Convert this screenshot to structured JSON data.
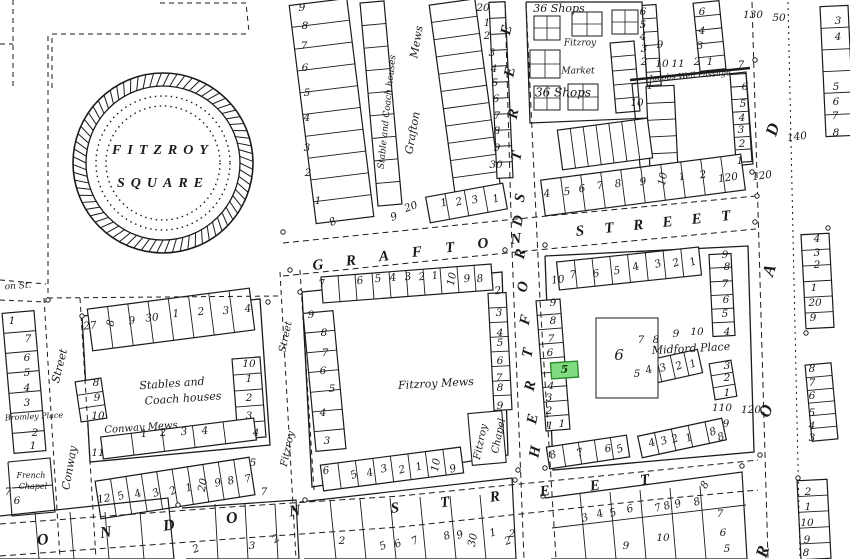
{
  "map": {
    "background": "#ffffff",
    "ink": "#1b1b1b",
    "square": {
      "name_line1": "FITZROY",
      "name_line2": "SQUARE",
      "cx": 163,
      "cy": 163,
      "r_outer": 90,
      "r_inner": 77,
      "r_dot1": 67,
      "r_dot2": 57
    },
    "highlight": {
      "number": "5",
      "x": 551,
      "y": 362,
      "w": 27,
      "h": 16,
      "rot": -4,
      "fill": "#80DC80",
      "stroke": "#2E8B2E",
      "text_color": "#14430F"
    },
    "street_names": [
      {
        "t": "GRAFTON",
        "x1": 318,
        "y1": 266,
        "x2": 516,
        "y2": 240,
        "s": 15,
        "lr": -6
      },
      {
        "t": "STREET",
        "x1": 580,
        "y1": 232,
        "x2": 726,
        "y2": 217,
        "s": 15,
        "lr": -6
      },
      {
        "t": "HERTFORD",
        "x1": 536,
        "y1": 452,
        "x2": 519,
        "y2": 221,
        "s": 15,
        "lr": -78
      },
      {
        "t": "STREET",
        "x1": 521,
        "y1": 198,
        "x2": 504,
        "y2": -12,
        "s": 15,
        "lr": -78
      },
      {
        "t": "LONDON",
        "x1": -20,
        "y1": 548,
        "x2": 295,
        "y2": 512,
        "s": 16,
        "lr": -8
      },
      {
        "t": "STREET",
        "x1": 395,
        "y1": 509,
        "x2": 645,
        "y2": 481,
        "s": 15,
        "lr": -8
      },
      {
        "t": "ROAD",
        "x1": 764,
        "y1": 552,
        "x2": 774,
        "y2": 130,
        "s": 17,
        "lr": -72
      }
    ],
    "labels": [
      {
        "t": "36 Shops",
        "x": 559,
        "y": 9,
        "s": 11
      },
      {
        "t": "Fitzroy",
        "x": 580,
        "y": 43,
        "s": 9
      },
      {
        "t": "Market",
        "x": 578,
        "y": 71,
        "s": 9
      },
      {
        "t": "36 Shops",
        "x": 563,
        "y": 93,
        "s": 12
      },
      {
        "t": "Jacobs Well Passage",
        "x": 690,
        "y": 76,
        "s": 8,
        "r": -4
      },
      {
        "t": "Mews",
        "x": 417,
        "y": 42,
        "s": 11,
        "r": -80
      },
      {
        "t": "Grafton",
        "x": 413,
        "y": 133,
        "s": 11,
        "r": -80
      },
      {
        "t": "Stable and Coach houses",
        "x": 387,
        "y": 112,
        "s": 9,
        "r": -84
      },
      {
        "t": "on St.",
        "x": 18,
        "y": 286,
        "s": 9,
        "r": -4
      },
      {
        "t": "Street",
        "x": 60,
        "y": 366,
        "s": 11,
        "r": -76
      },
      {
        "t": "Conway",
        "x": 70,
        "y": 468,
        "s": 11,
        "r": -80
      },
      {
        "t": "Bromley Place",
        "x": 34,
        "y": 417,
        "s": 8,
        "r": -3
      },
      {
        "t": "French",
        "x": 31,
        "y": 476,
        "s": 8
      },
      {
        "t": "Chapel",
        "x": 33,
        "y": 487,
        "s": 8
      },
      {
        "t": "Stables and",
        "x": 172,
        "y": 384,
        "s": 11,
        "r": -4
      },
      {
        "t": "Coach houses",
        "x": 183,
        "y": 399,
        "s": 11,
        "r": -4
      },
      {
        "t": "Conway Mews",
        "x": 141,
        "y": 428,
        "s": 10,
        "r": -4
      },
      {
        "t": "Street",
        "x": 286,
        "y": 337,
        "s": 10,
        "r": -78
      },
      {
        "t": "Fitzroy",
        "x": 288,
        "y": 449,
        "s": 10,
        "r": -78
      },
      {
        "t": "Fitzroy Mews",
        "x": 436,
        "y": 384,
        "s": 11,
        "r": -3
      },
      {
        "t": "Fitzroy",
        "x": 481,
        "y": 442,
        "s": 10,
        "r": -78
      },
      {
        "t": "Chapel",
        "x": 499,
        "y": 436,
        "s": 10,
        "r": -78
      },
      {
        "t": "Midford Place",
        "x": 691,
        "y": 349,
        "s": 11,
        "r": -3
      }
    ],
    "numbers": [
      [
        "9",
        302,
        8
      ],
      [
        "8",
        305,
        26
      ],
      [
        "7",
        304,
        46
      ],
      [
        "6",
        305,
        68
      ],
      [
        "5",
        307,
        93
      ],
      [
        "4",
        307,
        118
      ],
      [
        "3",
        307,
        148
      ],
      [
        "2",
        308,
        173
      ],
      [
        "1",
        318,
        201
      ],
      [
        "8",
        333,
        222,
        -30
      ],
      [
        "9",
        394,
        217,
        -20
      ],
      [
        "20",
        411,
        207,
        -20
      ],
      [
        "20",
        483,
        8
      ],
      [
        "1",
        487,
        23
      ],
      [
        "2",
        487,
        36
      ],
      [
        "3",
        492,
        53
      ],
      [
        "4",
        494,
        69
      ],
      [
        "5",
        495,
        83
      ],
      [
        "6",
        496,
        99
      ],
      [
        "7",
        497,
        116
      ],
      [
        "8",
        497,
        131
      ],
      [
        "9",
        497,
        148
      ],
      [
        "30",
        496,
        165
      ],
      [
        "1",
        444,
        203,
        -15
      ],
      [
        "2",
        459,
        202,
        -15
      ],
      [
        "3",
        475,
        200,
        -15
      ],
      [
        "1",
        496,
        199,
        -15
      ],
      [
        "6",
        643,
        12
      ],
      [
        "5",
        643,
        25
      ],
      [
        "4",
        643,
        37
      ],
      [
        "3",
        644,
        49
      ],
      [
        "2",
        644,
        62
      ],
      [
        "9",
        660,
        45
      ],
      [
        "10",
        662,
        64
      ],
      [
        "11",
        678,
        64
      ],
      [
        "6",
        702,
        12
      ],
      [
        "4",
        702,
        31
      ],
      [
        "3",
        700,
        46
      ],
      [
        "2",
        697,
        62
      ],
      [
        "1",
        710,
        62
      ],
      [
        "1",
        650,
        86
      ],
      [
        "10",
        637,
        103
      ],
      [
        "7",
        741,
        65
      ],
      [
        "6",
        745,
        87
      ],
      [
        "5",
        743,
        104
      ],
      [
        "4",
        742,
        118
      ],
      [
        "3",
        741,
        130
      ],
      [
        "2",
        742,
        144
      ],
      [
        "1",
        740,
        161
      ],
      [
        "4",
        547,
        194,
        -8
      ],
      [
        "5",
        567,
        192,
        -8
      ],
      [
        "6",
        582,
        189,
        -8
      ],
      [
        "7",
        600,
        186,
        -8
      ],
      [
        "8",
        618,
        184,
        -8
      ],
      [
        "9",
        643,
        182,
        -8
      ],
      [
        "10",
        663,
        179,
        -80
      ],
      [
        "1",
        682,
        177,
        -8
      ],
      [
        "2",
        703,
        175,
        -8
      ],
      [
        "120",
        728,
        178,
        -8
      ],
      [
        "120",
        762,
        176,
        -8
      ],
      [
        "140",
        797,
        137,
        -8
      ],
      [
        "130",
        753,
        15
      ],
      [
        "50",
        779,
        18
      ],
      [
        "7",
        322,
        284,
        -8
      ],
      [
        "6",
        360,
        281,
        -8
      ],
      [
        "5",
        378,
        279,
        -8
      ],
      [
        "4",
        393,
        278,
        -8
      ],
      [
        "3",
        408,
        277,
        -8
      ],
      [
        "2",
        422,
        277,
        -8
      ],
      [
        "1",
        435,
        276,
        -8
      ],
      [
        "10",
        452,
        279,
        -80
      ],
      [
        "9",
        467,
        279,
        -8
      ],
      [
        "8",
        480,
        279,
        -8
      ],
      [
        "2",
        498,
        291,
        -8
      ],
      [
        "9",
        311,
        315
      ],
      [
        "8",
        324,
        333
      ],
      [
        "7",
        325,
        353
      ],
      [
        "6",
        323,
        371
      ],
      [
        "5",
        332,
        389
      ],
      [
        "4",
        323,
        413
      ],
      [
        "3",
        327,
        441
      ],
      [
        "3",
        499,
        313
      ],
      [
        "4",
        500,
        333
      ],
      [
        "5",
        500,
        343
      ],
      [
        "6",
        500,
        361
      ],
      [
        "7",
        499,
        378
      ],
      [
        "8",
        500,
        388
      ],
      [
        "9",
        500,
        406
      ],
      [
        "6",
        326,
        471,
        -8
      ],
      [
        "5",
        354,
        475,
        -25
      ],
      [
        "4",
        370,
        473,
        -15
      ],
      [
        "3",
        384,
        469,
        -15
      ],
      [
        "2",
        402,
        470,
        -15
      ],
      [
        "1",
        419,
        467,
        -15
      ],
      [
        "10",
        436,
        465,
        -80
      ],
      [
        "9",
        453,
        469,
        -15
      ],
      [
        "27",
        90,
        326,
        -5
      ],
      [
        "8",
        111,
        323,
        -80
      ],
      [
        "9",
        132,
        321,
        -5
      ],
      [
        "30",
        152,
        318,
        -5
      ],
      [
        "1",
        176,
        314,
        -5
      ],
      [
        "2",
        201,
        312,
        -5
      ],
      [
        "3",
        226,
        311,
        -5
      ],
      [
        "4",
        248,
        309,
        -5
      ],
      [
        "8",
        96,
        383
      ],
      [
        "9",
        97,
        398
      ],
      [
        "10",
        98,
        416
      ],
      [
        "10",
        249,
        364
      ],
      [
        "1",
        249,
        379
      ],
      [
        "2",
        249,
        398
      ],
      [
        "3",
        249,
        416
      ],
      [
        "1",
        144,
        434,
        -5
      ],
      [
        "2",
        163,
        433,
        -5
      ],
      [
        "3",
        184,
        432,
        -5
      ],
      [
        "4",
        205,
        431,
        -5
      ],
      [
        "11",
        98,
        453
      ],
      [
        "12",
        104,
        499,
        -10
      ],
      [
        "5",
        121,
        496,
        -25
      ],
      [
        "4",
        138,
        494,
        -25
      ],
      [
        "3",
        156,
        493,
        -25
      ],
      [
        "2",
        173,
        491,
        -25
      ],
      [
        "1",
        189,
        488,
        -15
      ],
      [
        "20",
        203,
        485,
        -80
      ],
      [
        "9",
        218,
        483,
        -15
      ],
      [
        "8",
        231,
        481,
        -15
      ],
      [
        "7",
        248,
        479,
        -15
      ],
      [
        "4",
        256,
        433
      ],
      [
        "5",
        253,
        463
      ],
      [
        "7",
        264,
        492
      ],
      [
        "1",
        12,
        321
      ],
      [
        "7",
        28,
        339
      ],
      [
        "6",
        27,
        358
      ],
      [
        "5",
        27,
        373
      ],
      [
        "4",
        27,
        388
      ],
      [
        "3",
        27,
        403
      ],
      [
        "2",
        35,
        433
      ],
      [
        "1",
        33,
        446
      ],
      [
        "7",
        8,
        492
      ],
      [
        "6",
        17,
        501
      ],
      [
        "10",
        558,
        280,
        -8
      ],
      [
        "7",
        573,
        275,
        -8
      ],
      [
        "6",
        596,
        274,
        -8
      ],
      [
        "5",
        617,
        271,
        -8
      ],
      [
        "4",
        636,
        267,
        -20
      ],
      [
        "3",
        658,
        264,
        -20
      ],
      [
        "2",
        676,
        263,
        -20
      ],
      [
        "1",
        693,
        262,
        -20
      ],
      [
        "9",
        725,
        255
      ],
      [
        "8",
        727,
        267
      ],
      [
        "7",
        725,
        284
      ],
      [
        "6",
        726,
        300
      ],
      [
        "5",
        725,
        314
      ],
      [
        "4",
        727,
        332
      ],
      [
        "9",
        553,
        303
      ],
      [
        "8",
        553,
        321
      ],
      [
        "7",
        551,
        339
      ],
      [
        "6",
        550,
        353
      ],
      [
        "4",
        551,
        386
      ],
      [
        "3",
        549,
        398
      ],
      [
        "2",
        549,
        411
      ],
      [
        "1",
        550,
        426
      ],
      [
        "6",
        619,
        356,
        0,
        15
      ],
      [
        "7",
        641,
        340
      ],
      [
        "8",
        656,
        340
      ],
      [
        "9",
        676,
        334
      ],
      [
        "10",
        697,
        332
      ],
      [
        "5",
        637,
        374
      ],
      [
        "4",
        649,
        370,
        -20
      ],
      [
        "3",
        663,
        368,
        -20
      ],
      [
        "2",
        679,
        366,
        -20
      ],
      [
        "1",
        693,
        364,
        -20
      ],
      [
        "3",
        727,
        366
      ],
      [
        "2",
        727,
        378
      ],
      [
        "1",
        727,
        393
      ],
      [
        "110",
        722,
        408
      ],
      [
        "120",
        751,
        410
      ],
      [
        "9",
        726,
        424
      ],
      [
        "8",
        721,
        437,
        -20
      ],
      [
        "4",
        652,
        443,
        -20
      ],
      [
        "3",
        664,
        441,
        -20
      ],
      [
        "2",
        675,
        439,
        -20
      ],
      [
        "1",
        689,
        438,
        -20
      ],
      [
        "8",
        713,
        432,
        -20
      ],
      [
        "1",
        562,
        424
      ],
      [
        "8",
        553,
        455,
        -20
      ],
      [
        "7",
        580,
        453,
        -20
      ],
      [
        "6",
        608,
        449,
        -10
      ],
      [
        "5",
        620,
        449,
        -20
      ],
      [
        "2",
        342,
        541
      ],
      [
        "5",
        383,
        546,
        -25
      ],
      [
        "6",
        398,
        544,
        -25
      ],
      [
        "7",
        415,
        541,
        -25
      ],
      [
        "8",
        447,
        536,
        -20
      ],
      [
        "9",
        460,
        535,
        -20
      ],
      [
        "30",
        473,
        540,
        -80
      ],
      [
        "1",
        493,
        533,
        -15
      ],
      [
        "2",
        508,
        541,
        -20
      ],
      [
        "3",
        252,
        546
      ],
      [
        "2",
        196,
        549,
        -20
      ],
      [
        "2",
        276,
        539,
        -30
      ],
      [
        "3",
        585,
        518,
        -20
      ],
      [
        "4",
        600,
        514,
        -20
      ],
      [
        "5",
        613,
        513,
        -20
      ],
      [
        "6",
        630,
        509,
        -20
      ],
      [
        "7",
        658,
        508,
        -20
      ],
      [
        "8",
        667,
        506,
        -20
      ],
      [
        "9",
        678,
        504,
        -20
      ],
      [
        "8",
        697,
        502,
        -20
      ],
      [
        "8",
        705,
        485,
        -60
      ],
      [
        "7",
        720,
        514
      ],
      [
        "6",
        723,
        533
      ],
      [
        "5",
        727,
        549
      ],
      [
        "10",
        663,
        538
      ],
      [
        "9",
        626,
        546
      ],
      [
        "2",
        512,
        534
      ],
      [
        "3",
        838,
        21
      ],
      [
        "4",
        838,
        37
      ],
      [
        "5",
        836,
        87
      ],
      [
        "6",
        836,
        102
      ],
      [
        "7",
        835,
        116
      ],
      [
        "8",
        836,
        133
      ],
      [
        "4",
        817,
        239
      ],
      [
        "3",
        817,
        253
      ],
      [
        "2",
        817,
        265
      ],
      [
        "1",
        814,
        288
      ],
      [
        "20",
        815,
        303
      ],
      [
        "9",
        813,
        318
      ],
      [
        "8",
        812,
        369
      ],
      [
        "7",
        812,
        383
      ],
      [
        "6",
        812,
        396
      ],
      [
        "5",
        812,
        413
      ],
      [
        "4",
        812,
        426
      ],
      [
        "3",
        812,
        438
      ],
      [
        "2",
        808,
        492
      ],
      [
        "1",
        808,
        507
      ],
      [
        "10",
        807,
        523
      ],
      [
        "9",
        807,
        540
      ],
      [
        "8",
        806,
        553
      ]
    ]
  }
}
